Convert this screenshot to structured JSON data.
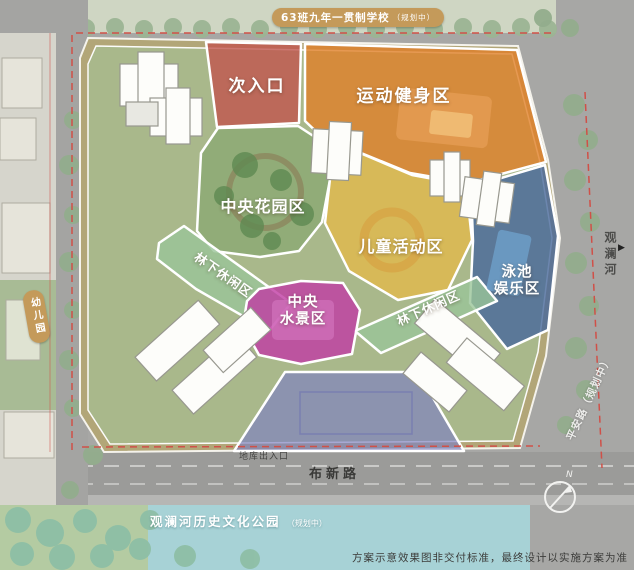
{
  "zones": [
    {
      "name": "secondary-entrance",
      "label": "次入口",
      "color": "#c0554e"
    },
    {
      "name": "sports-fitness",
      "label": "运动健身区",
      "color": "#e07f28"
    },
    {
      "name": "central-garden",
      "label": "中央花园区",
      "color": "#7da269"
    },
    {
      "name": "children-activity",
      "label": "儿童活动区",
      "color": "#e2b94b"
    },
    {
      "name": "pool-entertainment",
      "label": "泳池\n娱乐区",
      "color": "#47689b"
    },
    {
      "name": "central-waterscape",
      "label": "中央\n水景区",
      "color": "#c13ba4"
    },
    {
      "name": "forest-leisure-left",
      "label": "林下休闲区",
      "color": "#9ac498"
    },
    {
      "name": "forest-leisure-right",
      "label": "林下休闲区",
      "color": "#9ac498"
    },
    {
      "name": "entry-plaza",
      "label": "",
      "color": "#7f82c0"
    }
  ],
  "surroundings": {
    "school": "63班九年一贯制学校",
    "school_status": "（规划中）",
    "kindergarten": "幼儿园",
    "river": "观澜河",
    "river_arrow": "▶",
    "pingan_road": "平安路（规划中）",
    "buxin_road": "布新路",
    "garage_entrance": "地库出入口",
    "park": "观澜河历史文化公园",
    "park_status": "（规划中）"
  },
  "compass": {
    "north": "N"
  },
  "footer": {
    "disclaimer": "方案示意效果图非交付标准，最终设计以实施方案为准"
  },
  "colors": {
    "road": "#a7a7a5",
    "water": "#a7d2d6",
    "site_band": "#b2a678",
    "lawn": "#a9b98c",
    "label_pill": "#c49a5a",
    "boundary_red": "#d05048"
  }
}
